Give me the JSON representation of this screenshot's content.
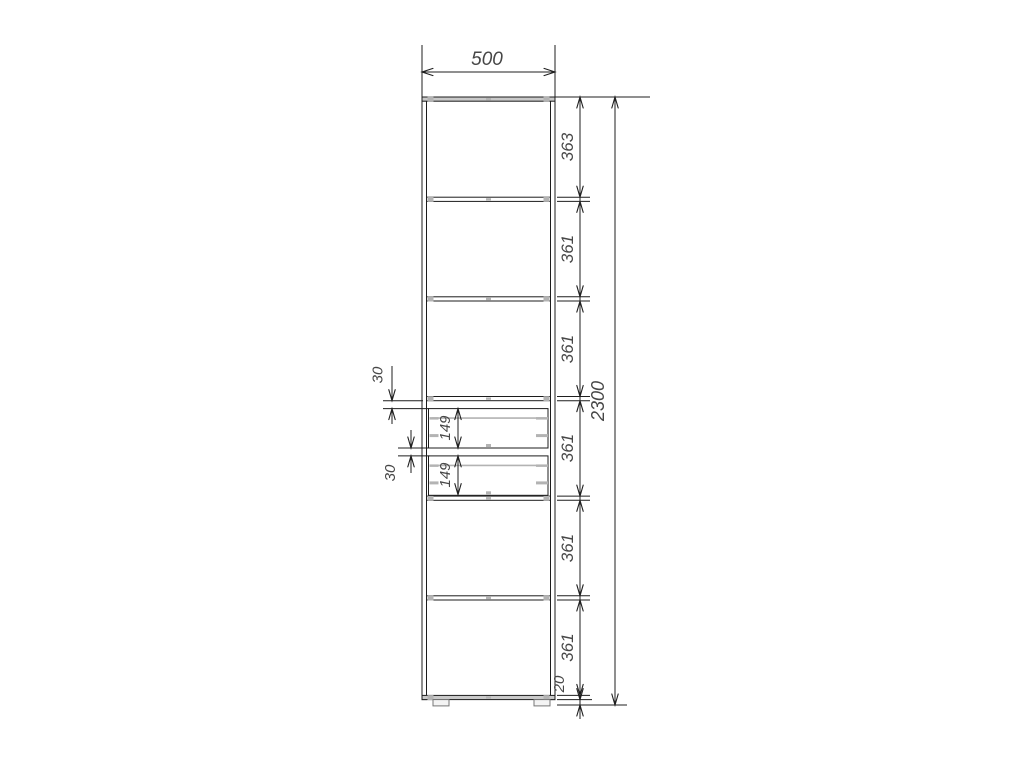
{
  "drawing": {
    "overall": {
      "width": "500",
      "height": "2300"
    },
    "sections": [
      "363",
      "361",
      "361",
      "361",
      "361",
      "361"
    ],
    "plinth_height": "20",
    "drawer_dims": {
      "gap_top": "30",
      "front_1": "149",
      "gap_between": "30",
      "front_2": "149"
    }
  }
}
